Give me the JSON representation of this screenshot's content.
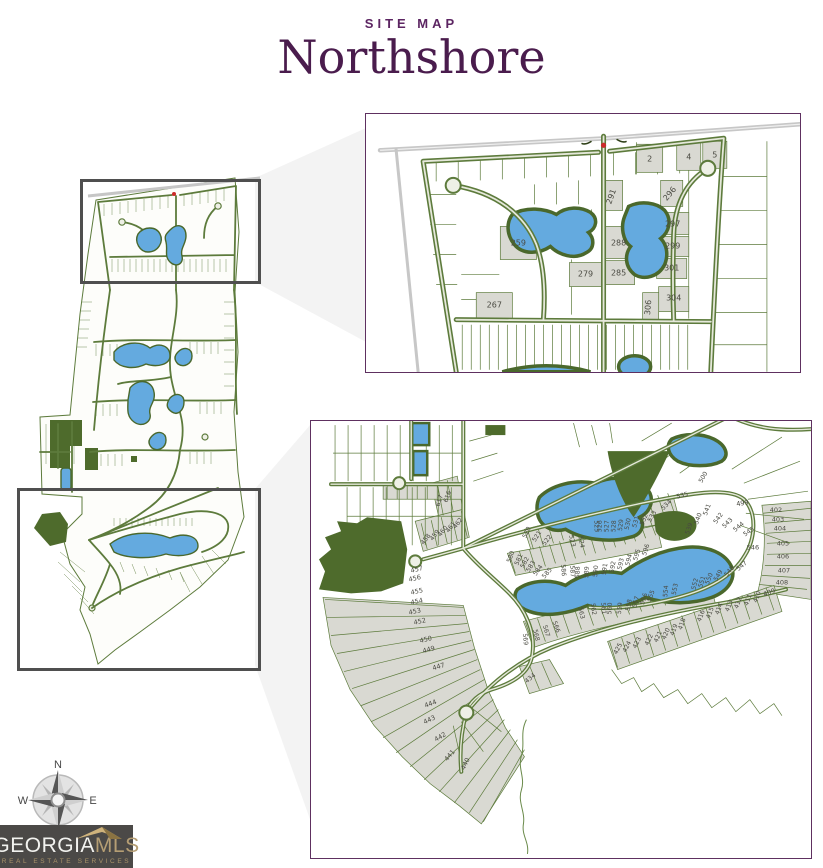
{
  "header": {
    "eyebrow": "SITE MAP",
    "title": "Northshore"
  },
  "compass": {
    "north": "N",
    "east": "E",
    "west": "W"
  },
  "logo": {
    "brand": "GEORGIA",
    "brand_suffix": "MLS",
    "tagline": "REAL ESTATE SERVICES"
  },
  "colors": {
    "title_purple": "#4a1c4d",
    "eyebrow_purple": "#5c2562",
    "inset_border": "#5e3060",
    "highlight_border": "#4f4f4f",
    "road_green": "#5d7b3c",
    "lake_blue": "#64aadf",
    "lake_shore": "#4a682c",
    "forest_green": "#4e6b2c",
    "lot_gray": "#d9d9d2",
    "highway_gray": "#c7c7c7",
    "beam_gray": "#f3f3f3",
    "marker_red": "#cc2b2b",
    "logo_bg": "#4b4947",
    "logo_gold": "#b59e74"
  },
  "inset_top": {
    "lots": [
      {
        "t": "2",
        "x": 283,
        "y": 47
      },
      {
        "t": "4",
        "x": 322,
        "y": 45
      },
      {
        "t": "5",
        "x": 348,
        "y": 43
      },
      {
        "t": "291",
        "x": 247,
        "y": 83,
        "r": -70
      },
      {
        "t": "296",
        "x": 305,
        "y": 81,
        "r": -50
      },
      {
        "t": "259",
        "x": 152,
        "y": 131
      },
      {
        "t": "288",
        "x": 252,
        "y": 131
      },
      {
        "t": "297",
        "x": 306,
        "y": 112
      },
      {
        "t": "299",
        "x": 306,
        "y": 134
      },
      {
        "t": "301",
        "x": 305,
        "y": 156
      },
      {
        "t": "285",
        "x": 252,
        "y": 161
      },
      {
        "t": "279",
        "x": 219,
        "y": 162
      },
      {
        "t": "267",
        "x": 128,
        "y": 193
      },
      {
        "t": "304",
        "x": 307,
        "y": 186
      },
      {
        "t": "306",
        "x": 284,
        "y": 193,
        "r": -85
      }
    ]
  },
  "inset_bottom": {
    "lots": [
      {
        "t": "535",
        "x": 371,
        "y": 76,
        "r": -15
      },
      {
        "t": "500",
        "x": 393,
        "y": 57,
        "r": -60
      },
      {
        "t": "499",
        "x": 431,
        "y": 84,
        "r": -10,
        "fs": 6.5
      },
      {
        "t": "402",
        "x": 464,
        "y": 91,
        "fs": 6.5
      },
      {
        "t": "403",
        "x": 466,
        "y": 100,
        "fs": 6.5
      },
      {
        "t": "404",
        "x": 468,
        "y": 109,
        "fs": 6.5
      },
      {
        "t": "405",
        "x": 471,
        "y": 124,
        "fs": 6.5
      },
      {
        "t": "406",
        "x": 471,
        "y": 137,
        "fs": 6.5
      },
      {
        "t": "546",
        "x": 441,
        "y": 128,
        "fs": 6.5
      },
      {
        "t": "407",
        "x": 472,
        "y": 151,
        "fs": 6.5
      },
      {
        "t": "408",
        "x": 470,
        "y": 163,
        "fs": 6.5
      },
      {
        "t": "409",
        "x": 458,
        "y": 173,
        "r": -20,
        "fs": 6.5
      },
      {
        "t": "541",
        "x": 397,
        "y": 89,
        "r": -70
      },
      {
        "t": "540",
        "x": 388,
        "y": 98,
        "r": -70
      },
      {
        "t": "539",
        "x": 379,
        "y": 108,
        "r": -70
      },
      {
        "t": "542",
        "x": 408,
        "y": 98,
        "r": -55
      },
      {
        "t": "543",
        "x": 417,
        "y": 103,
        "r": -45
      },
      {
        "t": "544",
        "x": 428,
        "y": 107,
        "r": -40
      },
      {
        "t": "545",
        "x": 438,
        "y": 112,
        "r": -35
      },
      {
        "t": "547",
        "x": 431,
        "y": 146,
        "r": -40
      },
      {
        "t": "548",
        "x": 419,
        "y": 151,
        "r": -50
      },
      {
        "t": "549",
        "x": 408,
        "y": 155,
        "r": -60
      },
      {
        "t": "550",
        "x": 399,
        "y": 158,
        "r": -68
      },
      {
        "t": "551",
        "x": 392,
        "y": 161,
        "r": -72
      },
      {
        "t": "552",
        "x": 385,
        "y": 163,
        "r": -76
      },
      {
        "t": "553",
        "x": 365,
        "y": 168,
        "r": -80
      },
      {
        "t": "554",
        "x": 356,
        "y": 170,
        "r": -84
      },
      {
        "t": "534",
        "x": 356,
        "y": 85,
        "r": -45
      },
      {
        "t": "533",
        "x": 342,
        "y": 96,
        "r": -60
      },
      {
        "t": "532",
        "x": 334,
        "y": 99,
        "r": -68
      },
      {
        "t": "531",
        "x": 326,
        "y": 101,
        "r": -74
      },
      {
        "t": "530",
        "x": 318,
        "y": 103,
        "r": -80
      },
      {
        "t": "529",
        "x": 311,
        "y": 104,
        "r": -84
      },
      {
        "t": "528",
        "x": 304,
        "y": 105,
        "r": -86
      },
      {
        "t": "527",
        "x": 297,
        "y": 105,
        "r": -88
      },
      {
        "t": "526",
        "x": 290,
        "y": 105,
        "r": -88
      },
      {
        "t": "525",
        "x": 283,
        "y": 105,
        "r": 88
      },
      {
        "t": "524",
        "x": 268,
        "y": 121,
        "r": 80
      },
      {
        "t": "523",
        "x": 259,
        "y": 120,
        "r": 76
      },
      {
        "t": "522",
        "x": 237,
        "y": 120,
        "r": -52
      },
      {
        "t": "521",
        "x": 227,
        "y": 116,
        "r": -58
      },
      {
        "t": "520",
        "x": 217,
        "y": 112,
        "r": -64
      },
      {
        "t": "580",
        "x": 201,
        "y": 136,
        "r": -70
      },
      {
        "t": "581",
        "x": 209,
        "y": 139,
        "r": -66
      },
      {
        "t": "582",
        "x": 215,
        "y": 142,
        "r": -62
      },
      {
        "t": "583",
        "x": 221,
        "y": 146,
        "r": -58
      },
      {
        "t": "584",
        "x": 228,
        "y": 150,
        "r": -54
      },
      {
        "t": "585",
        "x": 237,
        "y": 153,
        "r": -50
      },
      {
        "t": "586",
        "x": 250,
        "y": 149,
        "r": 85
      },
      {
        "t": "587",
        "x": 259,
        "y": 150,
        "r": 87
      },
      {
        "t": "588",
        "x": 268,
        "y": 151,
        "r": -88
      },
      {
        "t": "589",
        "x": 277,
        "y": 151,
        "r": -86
      },
      {
        "t": "590",
        "x": 286,
        "y": 150,
        "r": -84
      },
      {
        "t": "591",
        "x": 295,
        "y": 148,
        "r": -82
      },
      {
        "t": "592",
        "x": 303,
        "y": 146,
        "r": -80
      },
      {
        "t": "593",
        "x": 311,
        "y": 143,
        "r": -78
      },
      {
        "t": "594",
        "x": 319,
        "y": 139,
        "r": -76
      },
      {
        "t": "595",
        "x": 327,
        "y": 134,
        "r": -74
      },
      {
        "t": "596",
        "x": 336,
        "y": 129,
        "r": -72
      },
      {
        "t": "555",
        "x": 341,
        "y": 175,
        "r": -70
      },
      {
        "t": "556",
        "x": 334,
        "y": 178,
        "r": -73
      },
      {
        "t": "557",
        "x": 326,
        "y": 181,
        "r": -76
      },
      {
        "t": "558",
        "x": 319,
        "y": 184,
        "r": -79
      },
      {
        "t": "559",
        "x": 310,
        "y": 187,
        "r": -83
      },
      {
        "t": "560",
        "x": 300,
        "y": 187,
        "r": -87
      },
      {
        "t": "561",
        "x": 290,
        "y": 187,
        "r": 86
      },
      {
        "t": "562",
        "x": 280,
        "y": 188,
        "r": 82
      },
      {
        "t": "563",
        "x": 268,
        "y": 192,
        "r": 78
      },
      {
        "t": "566",
        "x": 243,
        "y": 206,
        "r": 70
      },
      {
        "t": "567",
        "x": 233,
        "y": 210,
        "r": 73
      },
      {
        "t": "568",
        "x": 223,
        "y": 214,
        "r": 78
      },
      {
        "t": "569",
        "x": 212,
        "y": 218,
        "r": 84
      },
      {
        "t": "425",
        "x": 308,
        "y": 228,
        "r": -62
      },
      {
        "t": "424",
        "x": 317,
        "y": 226,
        "r": -63
      },
      {
        "t": "423",
        "x": 327,
        "y": 222,
        "r": -64
      },
      {
        "t": "422",
        "x": 339,
        "y": 219,
        "r": -65
      },
      {
        "t": "421",
        "x": 348,
        "y": 216,
        "r": -66
      },
      {
        "t": "420",
        "x": 356,
        "y": 213,
        "r": -67
      },
      {
        "t": "419",
        "x": 364,
        "y": 209,
        "r": -69
      },
      {
        "t": "418",
        "x": 372,
        "y": 203,
        "r": -71
      },
      {
        "t": "416",
        "x": 391,
        "y": 195,
        "r": -70
      },
      {
        "t": "415",
        "x": 400,
        "y": 192,
        "r": -70
      },
      {
        "t": "414",
        "x": 409,
        "y": 188,
        "r": -70
      },
      {
        "t": "413",
        "x": 419,
        "y": 185,
        "r": -70
      },
      {
        "t": "412",
        "x": 428,
        "y": 182,
        "r": -70
      },
      {
        "t": "411",
        "x": 438,
        "y": 179,
        "r": -70
      },
      {
        "t": "410",
        "x": 447,
        "y": 176,
        "r": -70
      },
      {
        "t": "434",
        "x": 220,
        "y": 258,
        "r": -40
      },
      {
        "t": "457",
        "x": 106,
        "y": 150,
        "r": -14,
        "fs": 6.5
      },
      {
        "t": "456",
        "x": 104,
        "y": 159,
        "r": -13,
        "fs": 6.5
      },
      {
        "t": "455",
        "x": 106,
        "y": 172,
        "r": -12,
        "fs": 6.5
      },
      {
        "t": "454",
        "x": 106,
        "y": 182,
        "r": -12,
        "fs": 6.5
      },
      {
        "t": "453",
        "x": 104,
        "y": 192,
        "r": -12,
        "fs": 6.5
      },
      {
        "t": "452",
        "x": 109,
        "y": 202,
        "r": -12,
        "fs": 6.5
      },
      {
        "t": "450",
        "x": 115,
        "y": 220,
        "r": -14,
        "fs": 6.5
      },
      {
        "t": "449",
        "x": 118,
        "y": 230,
        "r": -15,
        "fs": 6.5
      },
      {
        "t": "447",
        "x": 128,
        "y": 247,
        "r": -17,
        "fs": 6.5
      },
      {
        "t": "444",
        "x": 120,
        "y": 284,
        "r": -20,
        "fs": 6.5
      },
      {
        "t": "443",
        "x": 119,
        "y": 300,
        "r": -25,
        "fs": 6.5
      },
      {
        "t": "442",
        "x": 130,
        "y": 317,
        "r": -30,
        "fs": 6.5
      },
      {
        "t": "441",
        "x": 140,
        "y": 335,
        "r": -50,
        "fs": 6.5
      },
      {
        "t": "440",
        "x": 156,
        "y": 343,
        "r": -65,
        "fs": 6.5
      },
      {
        "t": "617",
        "x": 130,
        "y": 80,
        "r": -72
      },
      {
        "t": "616",
        "x": 138,
        "y": 76,
        "r": -70
      },
      {
        "t": "458",
        "x": 116,
        "y": 119,
        "r": -52
      },
      {
        "t": "459",
        "x": 125,
        "y": 115,
        "r": -52
      },
      {
        "t": "460",
        "x": 133,
        "y": 111,
        "r": -52
      },
      {
        "t": "461",
        "x": 141,
        "y": 107,
        "r": -52
      },
      {
        "t": "462",
        "x": 148,
        "y": 103,
        "r": -52
      }
    ]
  }
}
